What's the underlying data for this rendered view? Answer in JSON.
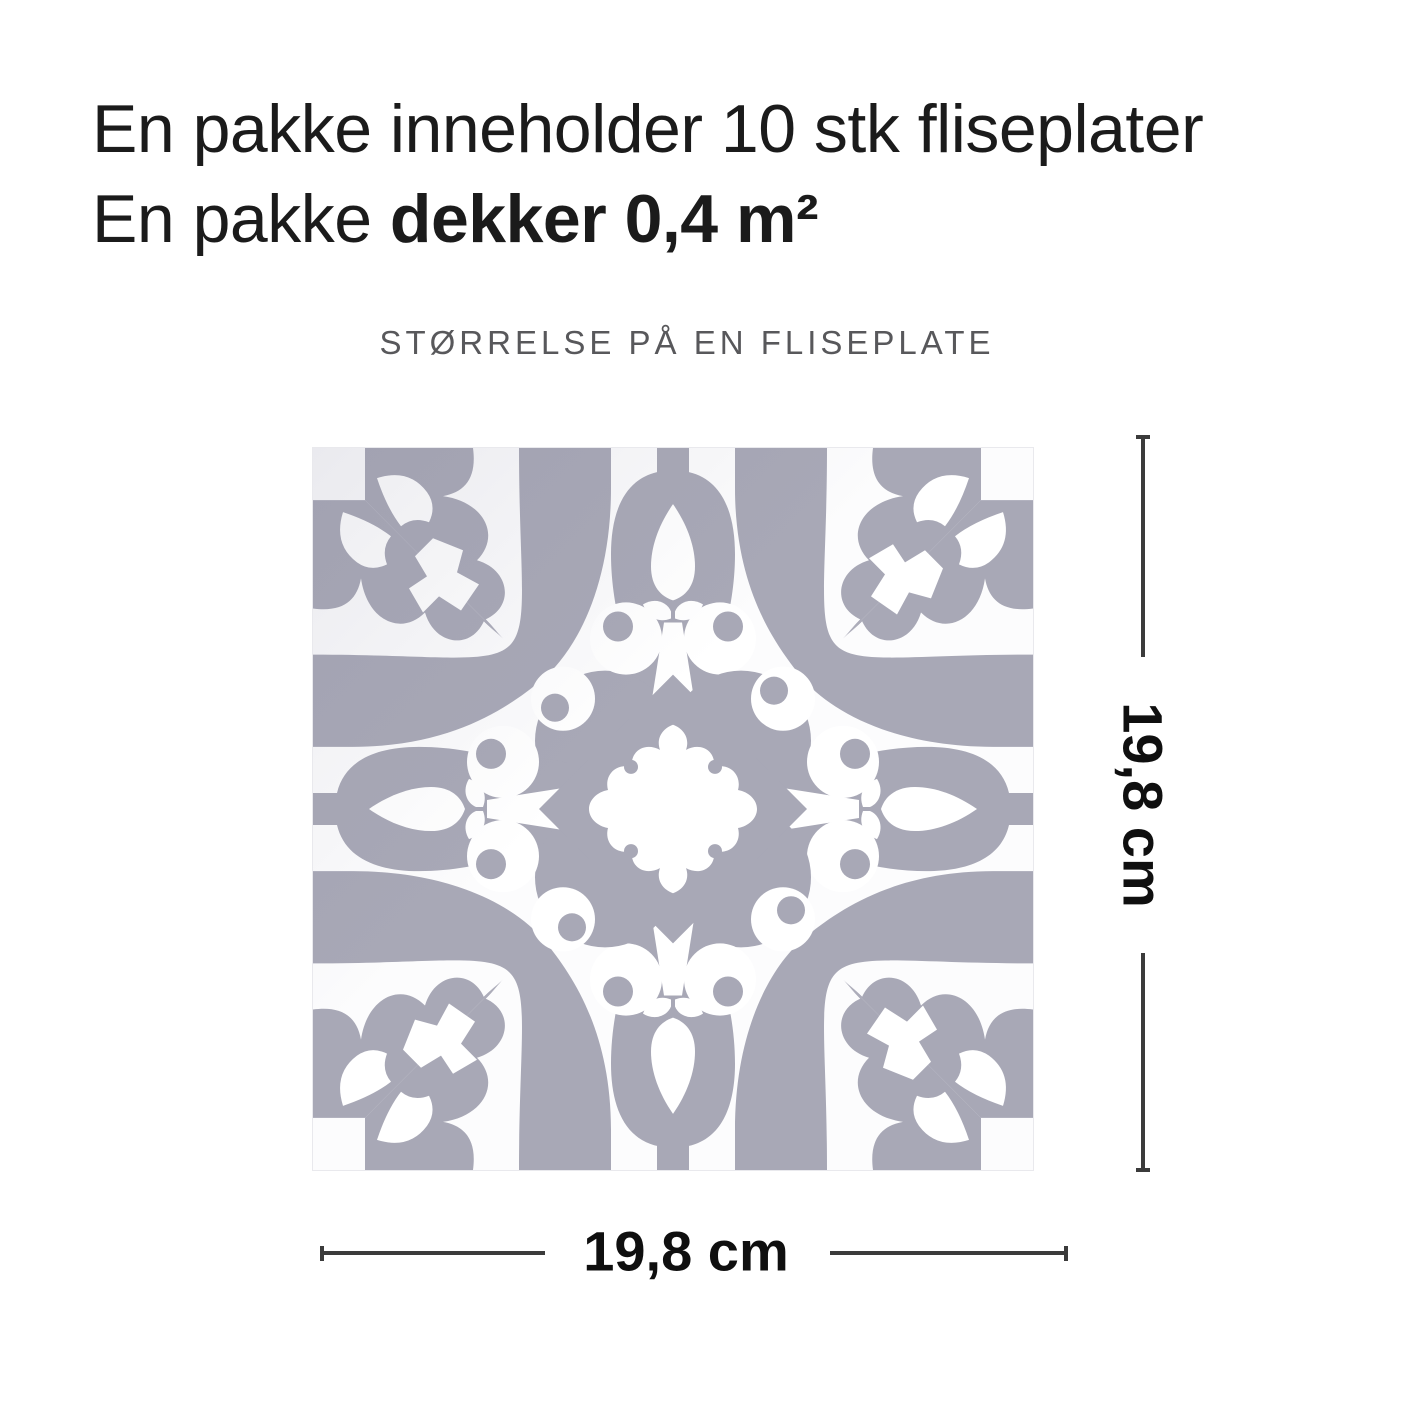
{
  "heading": {
    "line1": "En pakke inneholder 10 stk fliseplater",
    "line2_regular": "En pakke ",
    "line2_bold": "dekker 0,4 m²"
  },
  "size_caption": "STØRRELSE PÅ EN FLISEPLATE",
  "dimensions": {
    "height_label": "19,8 cm",
    "width_label": "19,8 cm"
  },
  "tile": {
    "description": "dekorativ fliseplate"
  },
  "colors": {
    "pattern": "#a8a8b6",
    "surface": "#fcfcfd",
    "ornament": "#ffffff",
    "dimension_line": "#3b3b3b",
    "heading_text": "#1b1b1b",
    "caption_text": "#58585b",
    "label_text": "#0f0f0f",
    "page_bg": "#ffffff",
    "tile_edge": "#e9e9ed"
  }
}
